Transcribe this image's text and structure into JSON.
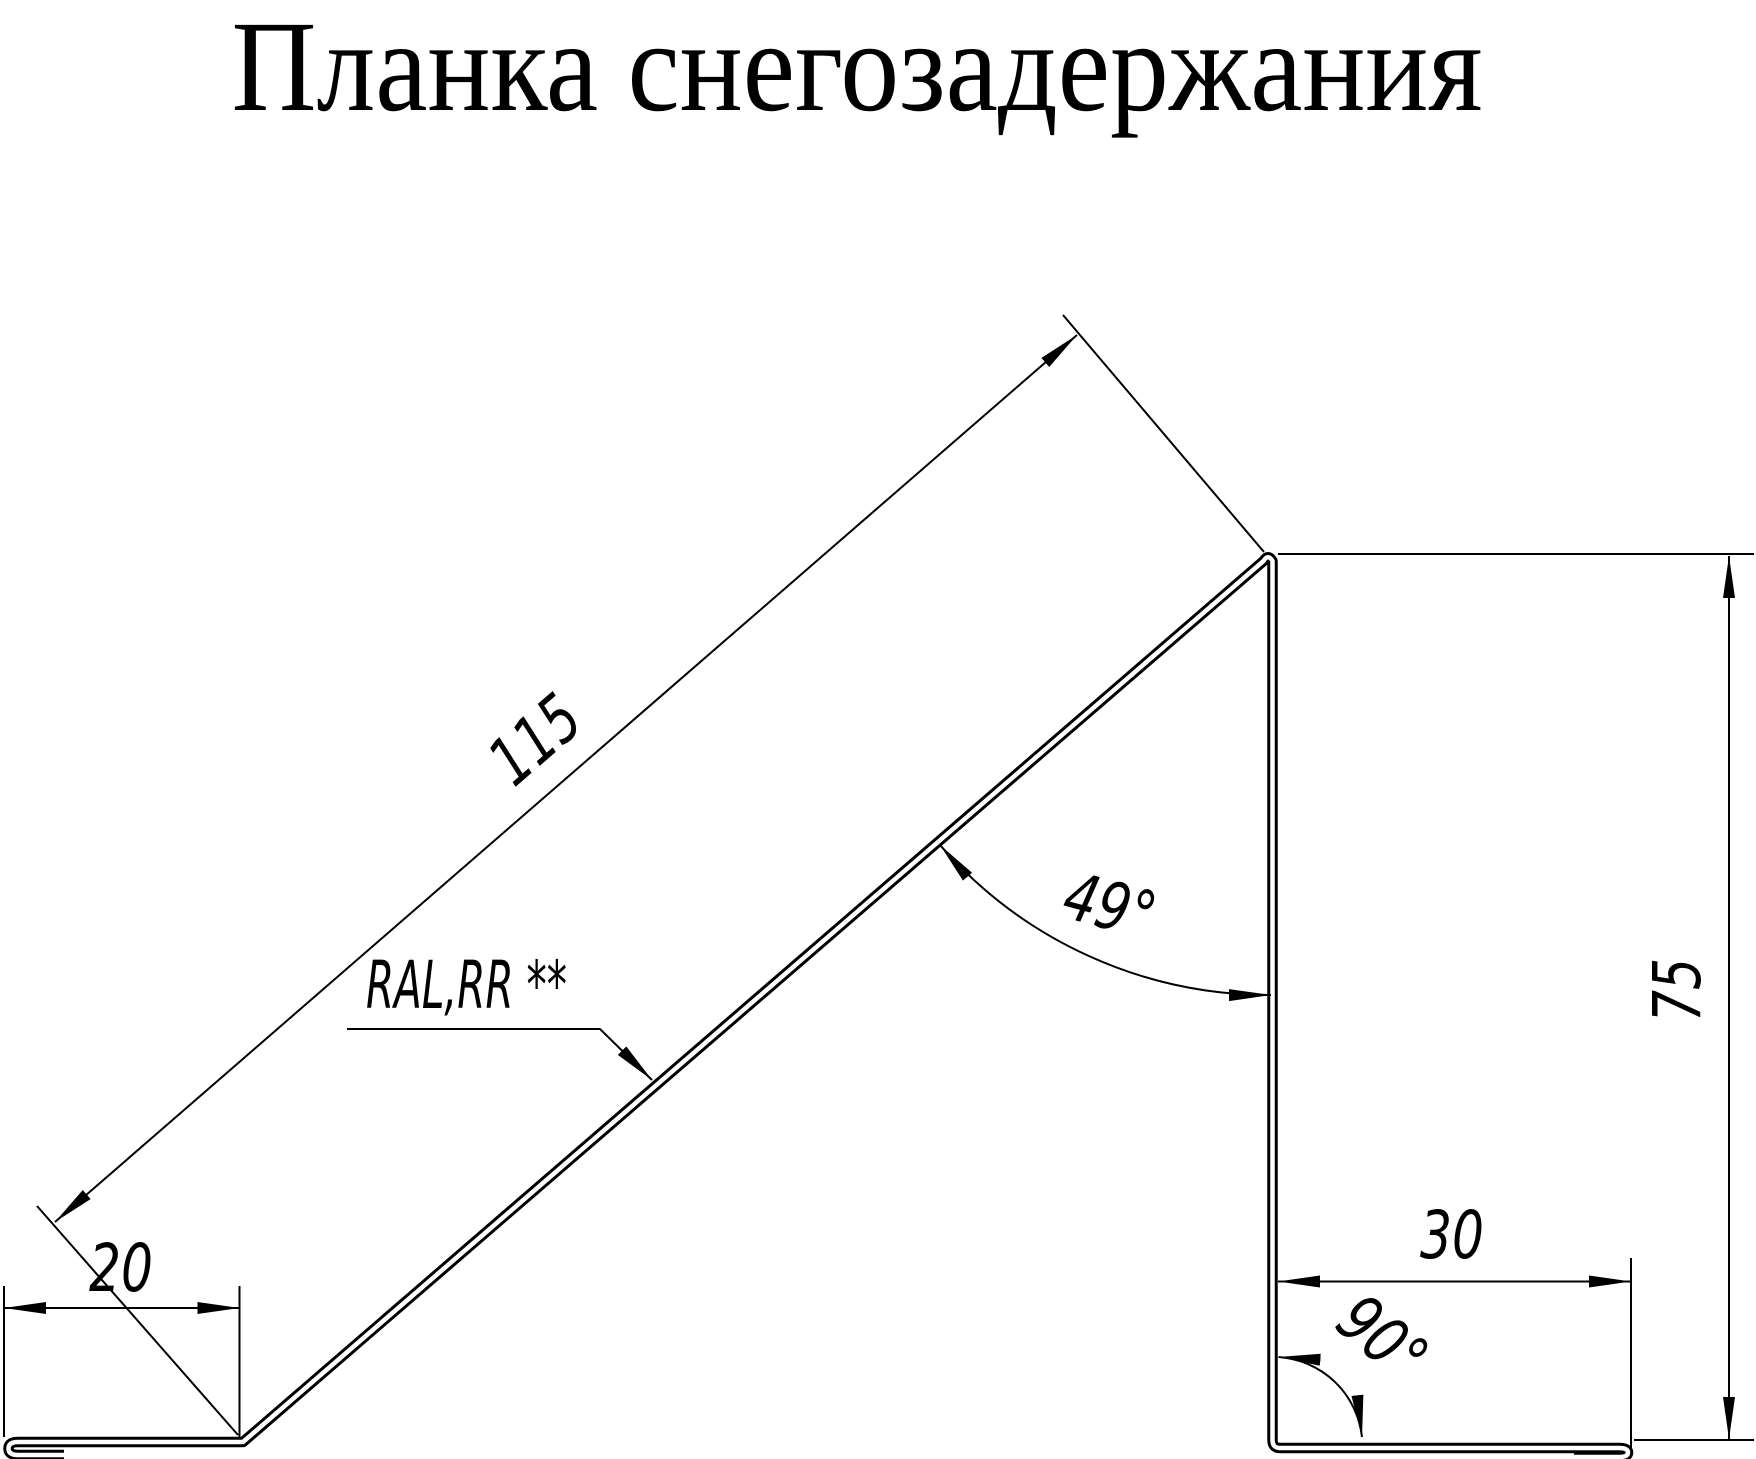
{
  "title": "Планка снегозадержания",
  "drawing": {
    "part_label": "RAL,RR **",
    "dims": {
      "slope_length": "115",
      "foot_width": "20",
      "flange_width": "30",
      "leg_height": "75",
      "slope_angle": "49°",
      "corner_angle": "90°"
    },
    "line_color": "#000000"
  }
}
